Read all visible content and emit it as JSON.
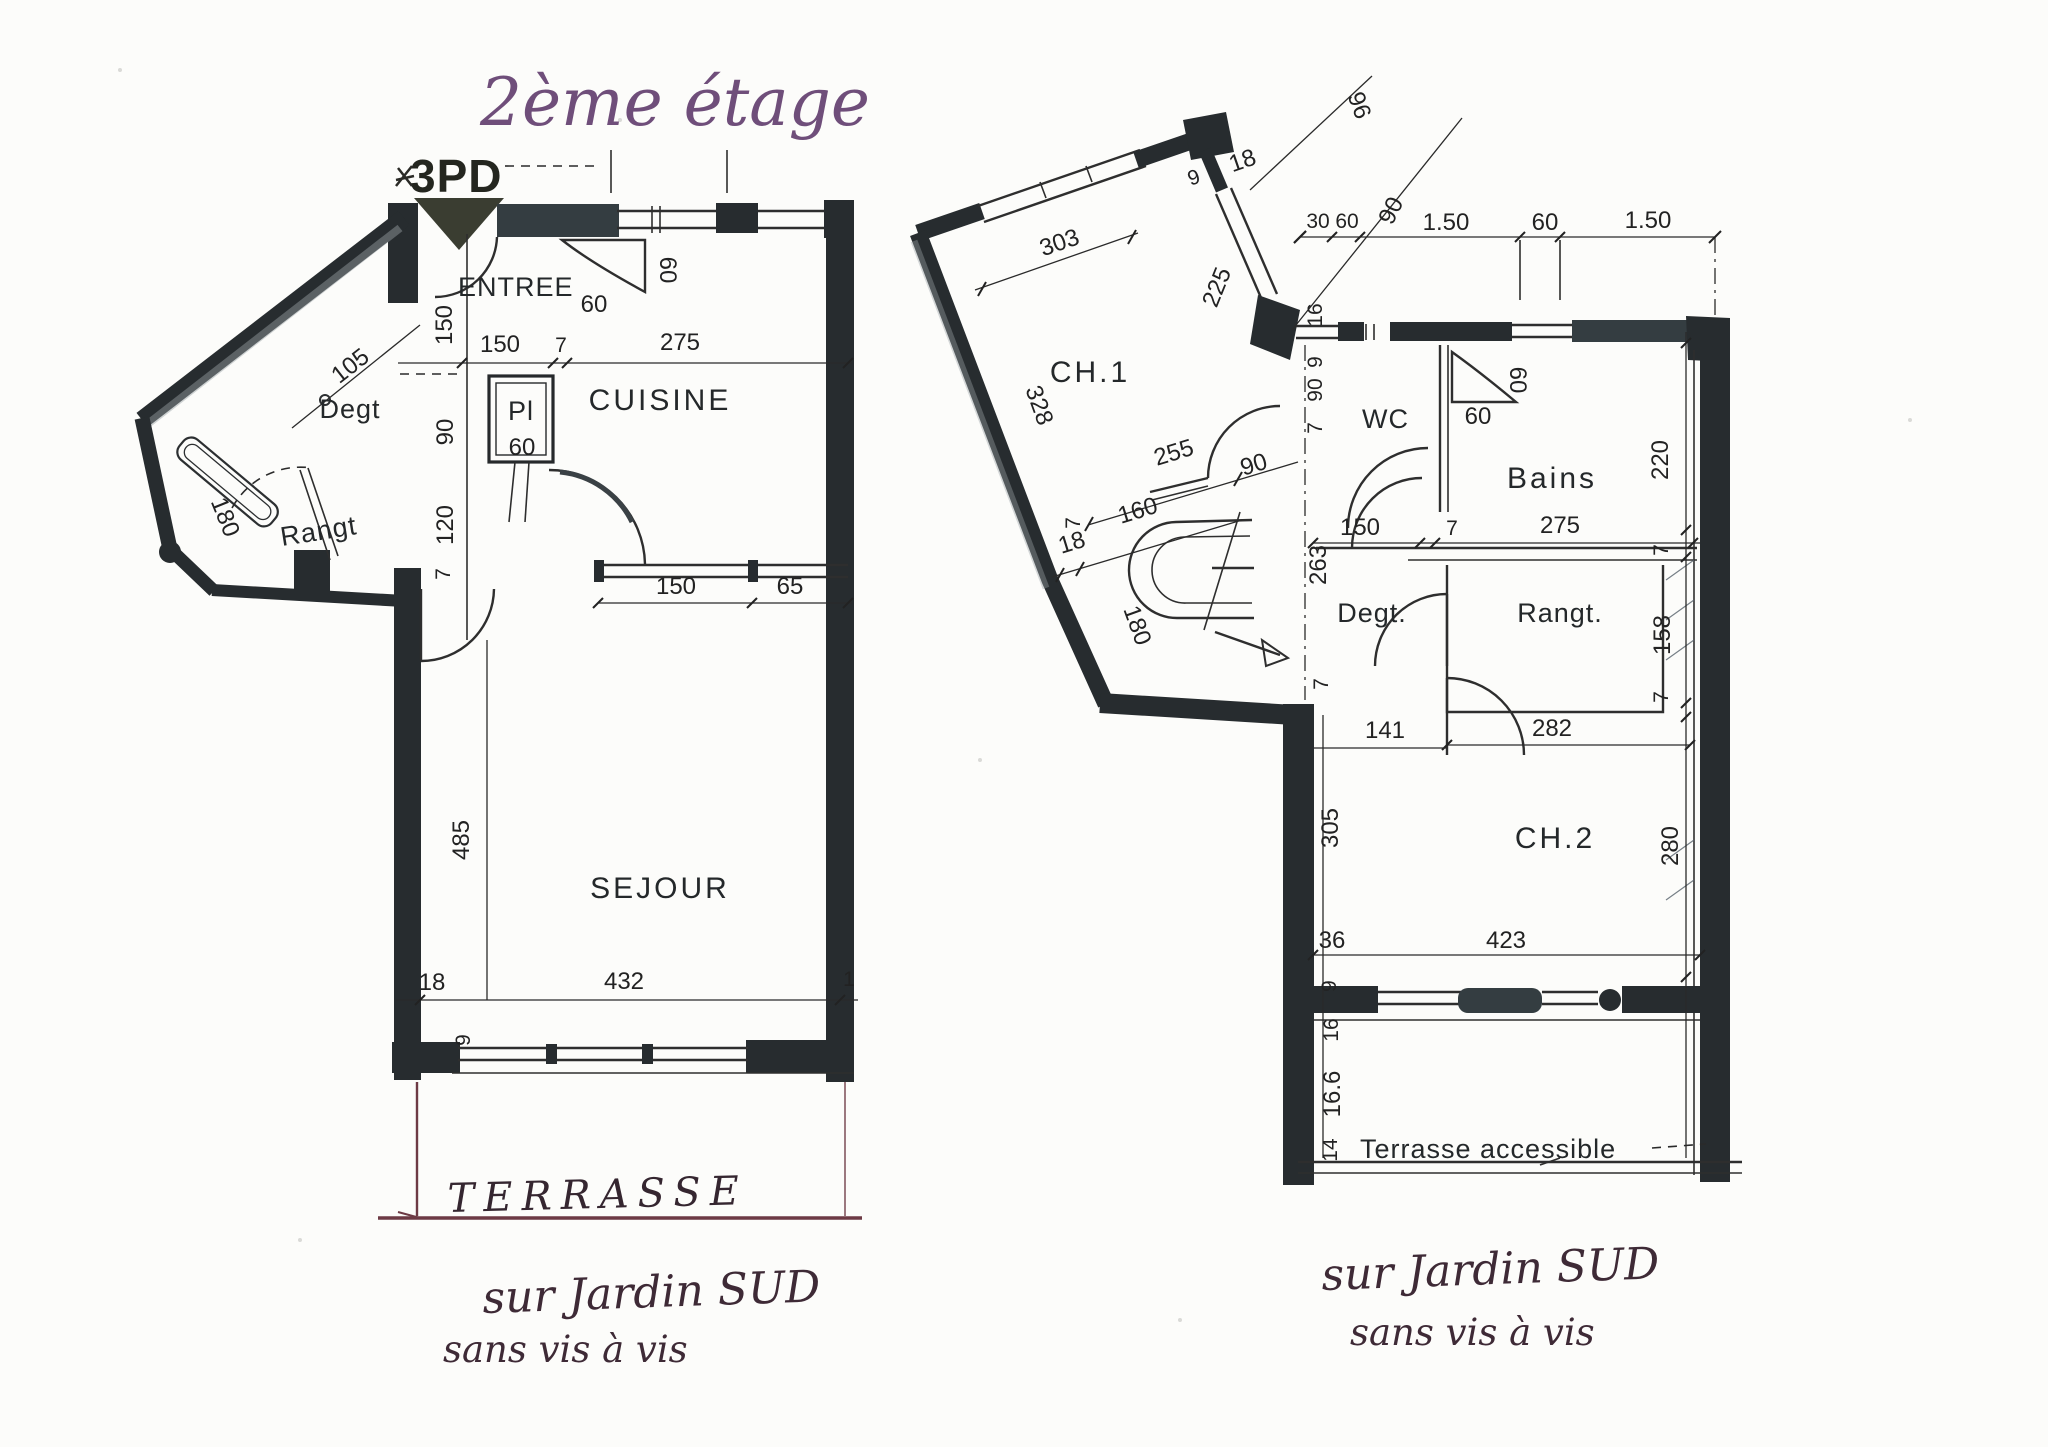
{
  "title": "2ème étage",
  "planA": {
    "marking": "3PD",
    "rooms": {
      "entree": "ENTREE",
      "degt": "Degt",
      "rangt": "Rangt",
      "pl": "Pl",
      "cuisine": "CUISINE",
      "sejour": "SEJOUR"
    },
    "terrasse": "TERRASSE",
    "dims": {
      "d105": "105",
      "ev150": "150",
      "h150": "150",
      "h7": "7",
      "h275": "275",
      "sp60v": "60",
      "sp60h": "60",
      "pl60": "60",
      "v90": "90",
      "v120": "120",
      "v7": "7",
      "r180": "180",
      "k150": "150",
      "k65": "65",
      "s485": "485",
      "s18": "18",
      "s432": "432",
      "s1": "1",
      "s9": "9"
    },
    "note1": "sur Jardin SUD",
    "note2": "sans vis à vis"
  },
  "planB": {
    "rooms": {
      "ch1": "CH.1",
      "wc": "WC",
      "bains": "Bains",
      "degt": "Degt.",
      "rangt": "Rangt.",
      "ch2": "CH.2"
    },
    "terrace": "Terrasse accessible",
    "dims": {
      "win303": "303",
      "a9": "9",
      "a18": "18",
      "a96": "96",
      "win225": "225",
      "t30": "30",
      "t60": "60",
      "t90": "90",
      "t150a": "1.50",
      "t60b": "60",
      "t150b": "1.50",
      "v16": "16",
      "v9": "9",
      "v90": "90",
      "v7": "7",
      "w328": "328",
      "c255": "255",
      "c90": "90",
      "c160": "160",
      "c18": "18",
      "c7": "7",
      "sp60v": "60",
      "sp60h": "60",
      "b220": "220",
      "h150": "150",
      "h7a": "7",
      "h275": "275",
      "h7r": "7",
      "v263": "263",
      "s180": "180",
      "d141": "141",
      "d7": "7",
      "r158": "158",
      "r7": "7",
      "r282": "282",
      "c2305": "305",
      "c236": "36",
      "c2423": "423",
      "c29": "9",
      "c216": "16",
      "c2280": "280",
      "ter166": "16.6",
      "ter14": "14"
    },
    "note1": "sur Jardin SUD",
    "note2": "sans vis à vis"
  }
}
